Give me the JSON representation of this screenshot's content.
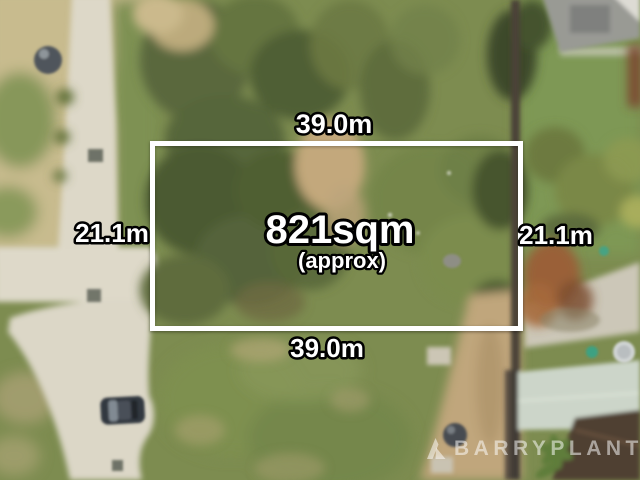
{
  "overlay": {
    "area": "821sqm",
    "area_qualifier": "(approx)",
    "width_top": "39.0m",
    "width_bottom": "39.0m",
    "depth_left": "21.1m",
    "depth_right": "21.1m",
    "boundary_color": "#ffffff",
    "label_text_color": "#ffffff",
    "label_outline_color": "#000000"
  },
  "watermark": {
    "brand": "BARRYPLANT",
    "logo_icon": "barry-plant-logo-icon",
    "color": "#ffffff"
  }
}
